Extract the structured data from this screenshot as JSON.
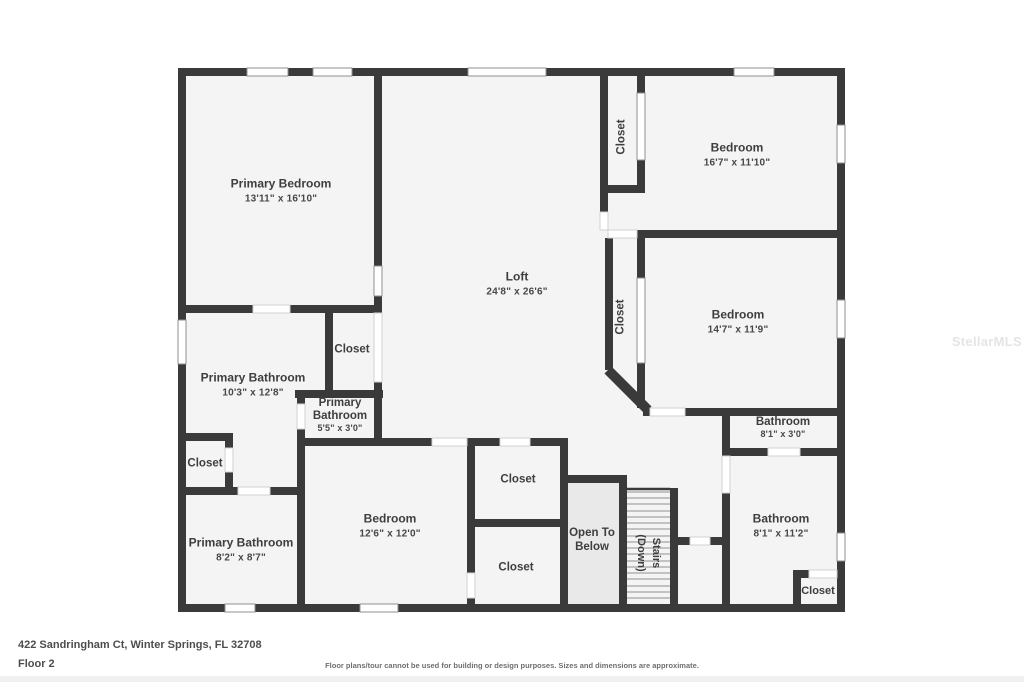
{
  "watermark": "StellarMLS",
  "footer": {
    "address": "422 Sandringham Ct, Winter Springs, FL 32708",
    "floor_label": "Floor 2",
    "disclaimer": "Floor plans/tour cannot be used for building or design purposes. Sizes and dimensions are approximate."
  },
  "colors": {
    "wall": "#3a3a3a",
    "room_fill": "#f4f4f4",
    "open_to_below_fill": "#e9e9e9"
  },
  "rooms": {
    "primary_bedroom": {
      "name": "Primary Bedroom",
      "dims": "13'11\" x 16'10\""
    },
    "loft": {
      "name": "Loft",
      "dims": "24'8\" x 26'6\""
    },
    "closet_top_right": {
      "name": "Closet"
    },
    "bedroom_top_right": {
      "name": "Bedroom",
      "dims": "16'7\" x 11'10\""
    },
    "closet_mid_right": {
      "name": "Closet"
    },
    "bedroom_mid_right": {
      "name": "Bedroom",
      "dims": "14'7\" x 11'9\""
    },
    "primary_bathroom_large": {
      "name": "Primary Bathroom",
      "dims": "10'3\" x 12'8\""
    },
    "closet_center": {
      "name": "Closet"
    },
    "primary_bathroom_small": {
      "name": "Primary Bathroom",
      "dims": "5'5\" x 3'0\""
    },
    "closet_left": {
      "name": "Closet"
    },
    "primary_bathroom_lower": {
      "name": "Primary Bathroom",
      "dims": "8'2\" x 8'7\""
    },
    "bedroom_bottom": {
      "name": "Bedroom",
      "dims": "12'6\" x 12'0\""
    },
    "closet_pair_upper": {
      "name": "Closet"
    },
    "closet_pair_lower": {
      "name": "Closet"
    },
    "open_to_below": {
      "name": "Open To Below"
    },
    "stairs": {
      "line1": "Stairs",
      "line2": "(Down)"
    },
    "bathroom_small": {
      "name": "Bathroom",
      "dims": "8'1\" x 3'0\""
    },
    "bathroom_right": {
      "name": "Bathroom",
      "dims": "8'1\" x 11'2\""
    },
    "closet_bottom_right": {
      "name": "Closet"
    }
  }
}
